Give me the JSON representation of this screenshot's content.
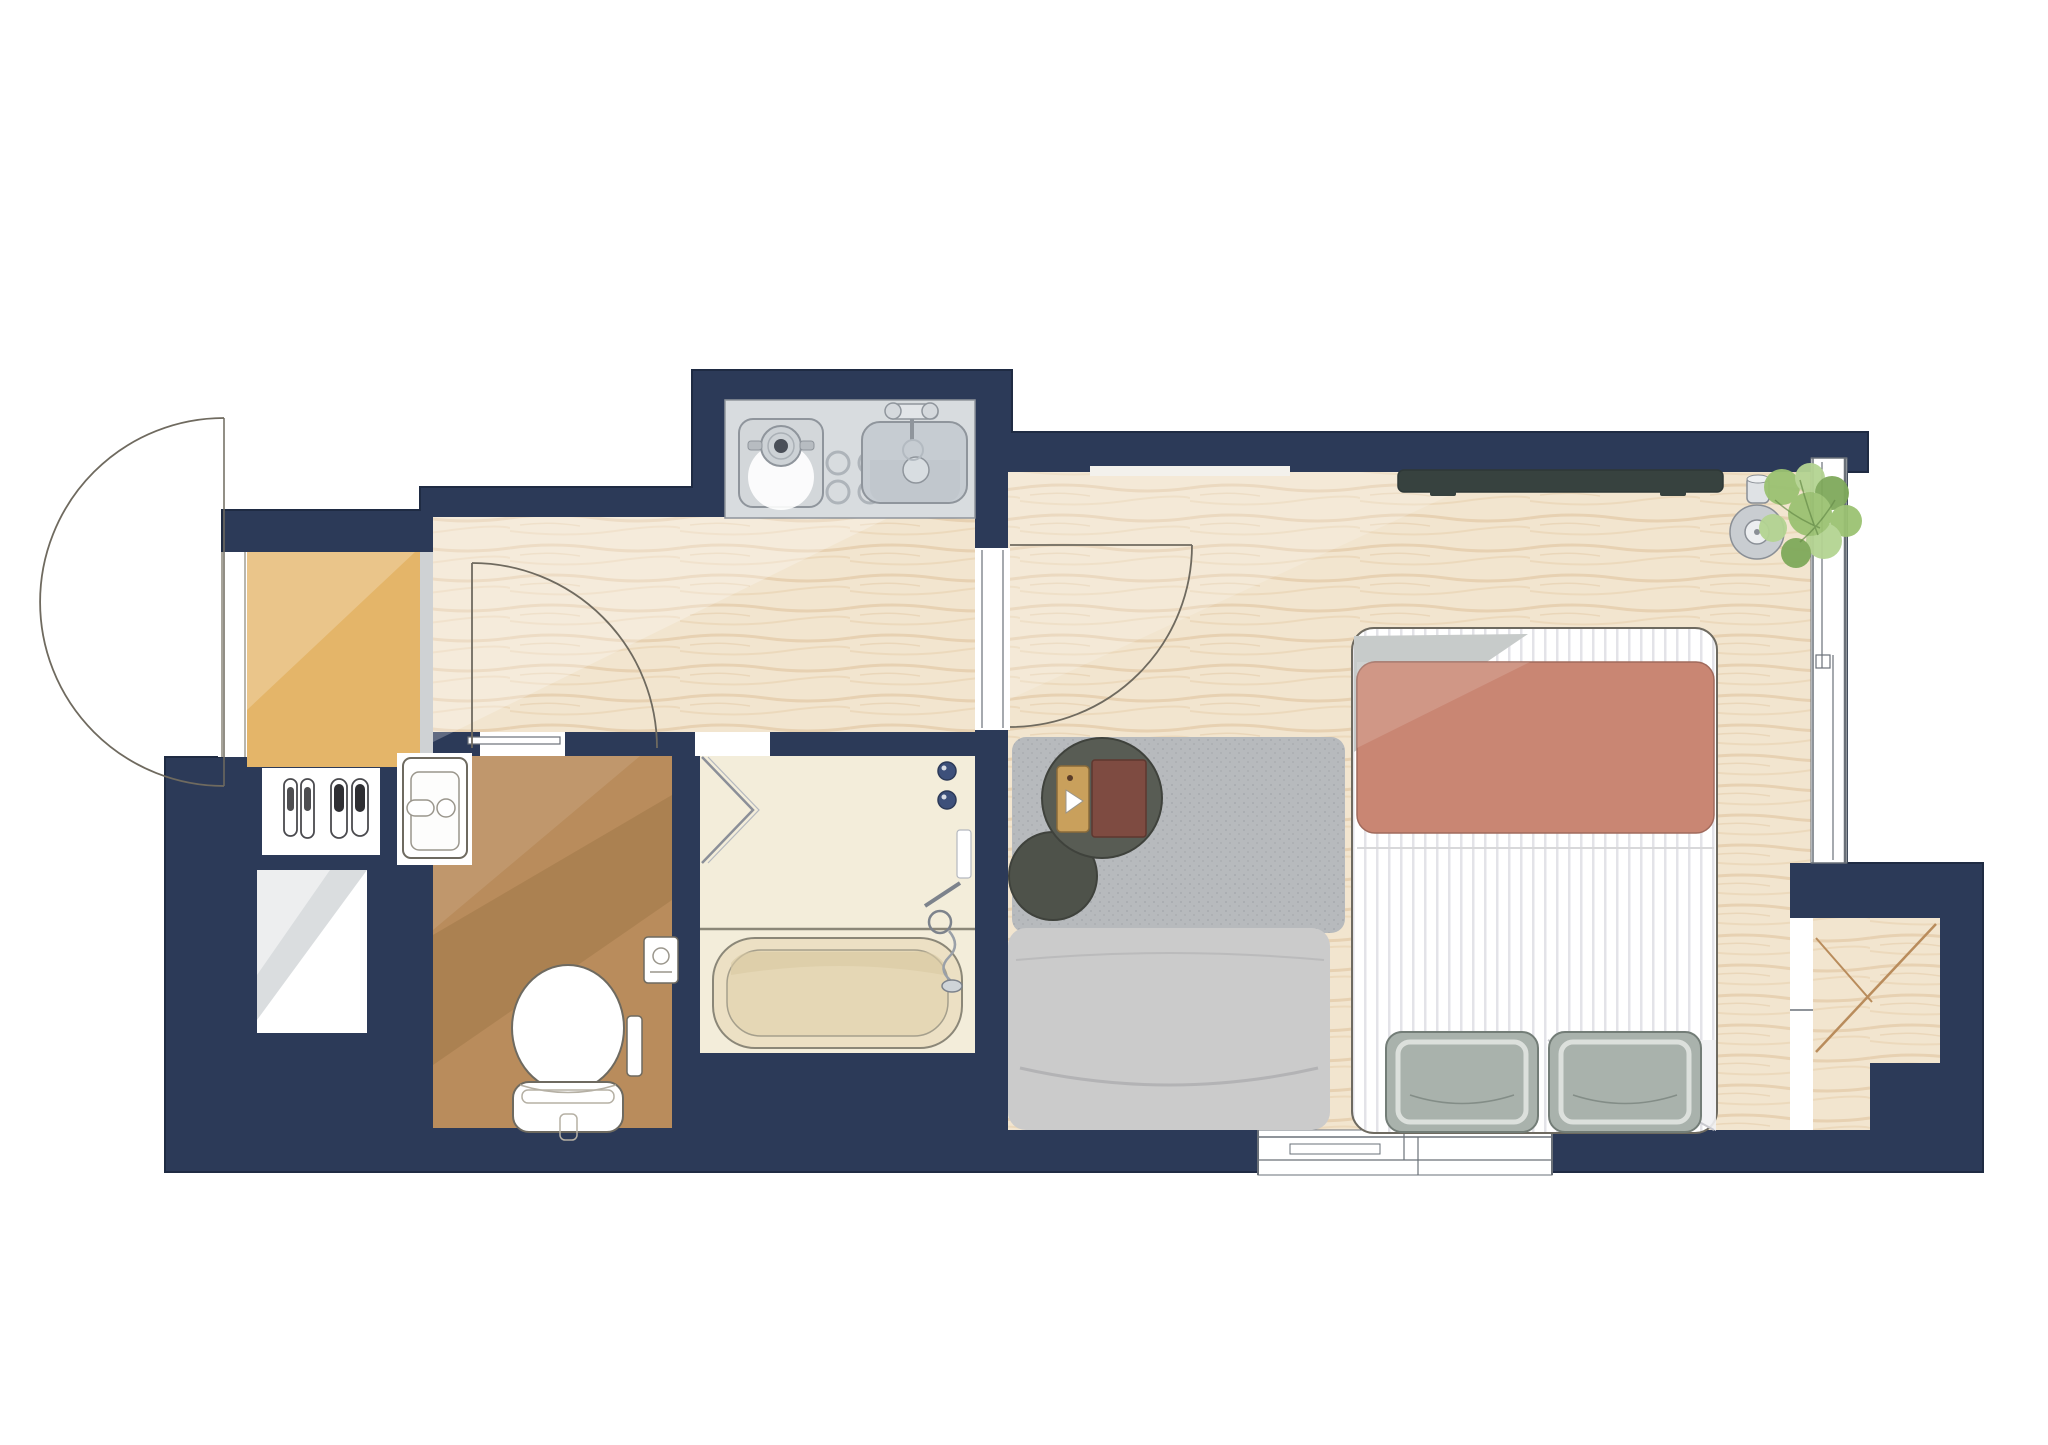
{
  "title": "Studio apartment floor plan (watercolor style, top-down view)",
  "rooms": [
    {
      "id": "genkan",
      "name": "entry (genkan)"
    },
    {
      "id": "hallway",
      "name": "hallway"
    },
    {
      "id": "kitchenette",
      "name": "kitchenette nook"
    },
    {
      "id": "toilet-room",
      "name": "toilet room"
    },
    {
      "id": "bathroom",
      "name": "bathroom / tub room"
    },
    {
      "id": "main-room",
      "name": "living + bedroom"
    },
    {
      "id": "closet-alcove",
      "name": "closet alcove"
    }
  ],
  "furniture": [
    "entry door (outward swing)",
    "interior hinged door (hallway)",
    "interior hinged door (main room)",
    "two pairs of slippers",
    "washbasin",
    "toilet with control panel",
    "toilet-paper holder",
    "folding bathroom door",
    "bathtub",
    "shower mixer and hand shower",
    "single burner cooktop",
    "kitchen sink with two-handle faucet",
    "trivet rings",
    "wall-mounted TV",
    "small speaker / robot vacuum",
    "potted plant",
    "area rug",
    "two round nesting side tables",
    "wood serving tray",
    "red book",
    "daybed / low sofa",
    "double bed with striped duvet",
    "terracotta blanket",
    "two sage pillows",
    "sliding window (right wall)",
    "window (bottom wall)",
    "storage niche (laundry space)"
  ],
  "colors": {
    "wall": "#2c3a58",
    "wall_outline": "#1f2b43",
    "white": "#ffffff",
    "wood_base": "#f2e5cf",
    "wood_grain1": "#d9b98f",
    "wood_grain2": "#e6cda9",
    "genkan": "#e4b569",
    "genkan_light": "#f0cd8d",
    "threshold": "#cfd2d4",
    "toilet_floor": "#b98c5c",
    "toilet_shade": "#8a6436",
    "bath_floor": "#f3edda",
    "tub_outer": "#ece0c4",
    "tub_inner": "#e5d7b5",
    "counter": "#d8dcdf",
    "sink_bowl": "#c6ccd2",
    "sink_shade": "#bfc6cd",
    "fixture": "#8f959c",
    "fixture_dark": "#3d507a",
    "line": "#6e6a60",
    "line_soft": "#a5a094",
    "window_line": "#6a7078",
    "rug": "#b7babd",
    "rug_dot": "#8e9296",
    "sofa": "#cbcbcb",
    "sofa_line": "#b3b3b5",
    "bed_stripe": "#e3e3e8",
    "blanket": "#c98673",
    "blanket_edge": "#a06a5c",
    "fold_gray": "#c7cbca",
    "pillow": "#a9b2ac",
    "pillow_line": "#737d77",
    "table_large": "#585c54",
    "table_small": "#4e524a",
    "table_edge": "#3f423c",
    "tray": "#c9a05c",
    "tray_edge": "#8a6b3a",
    "book": "#7e4b41",
    "book_edge": "#5f372f",
    "tv": "#37423f",
    "device": "#c9cdd1",
    "device_line": "#8a8f96",
    "plant_dark": "#7fa95b",
    "plant_mid": "#9bc272",
    "plant_light": "#b4d492",
    "niche_shade": "#aeb3b8",
    "slipper_dark": "#2f2f33"
  }
}
